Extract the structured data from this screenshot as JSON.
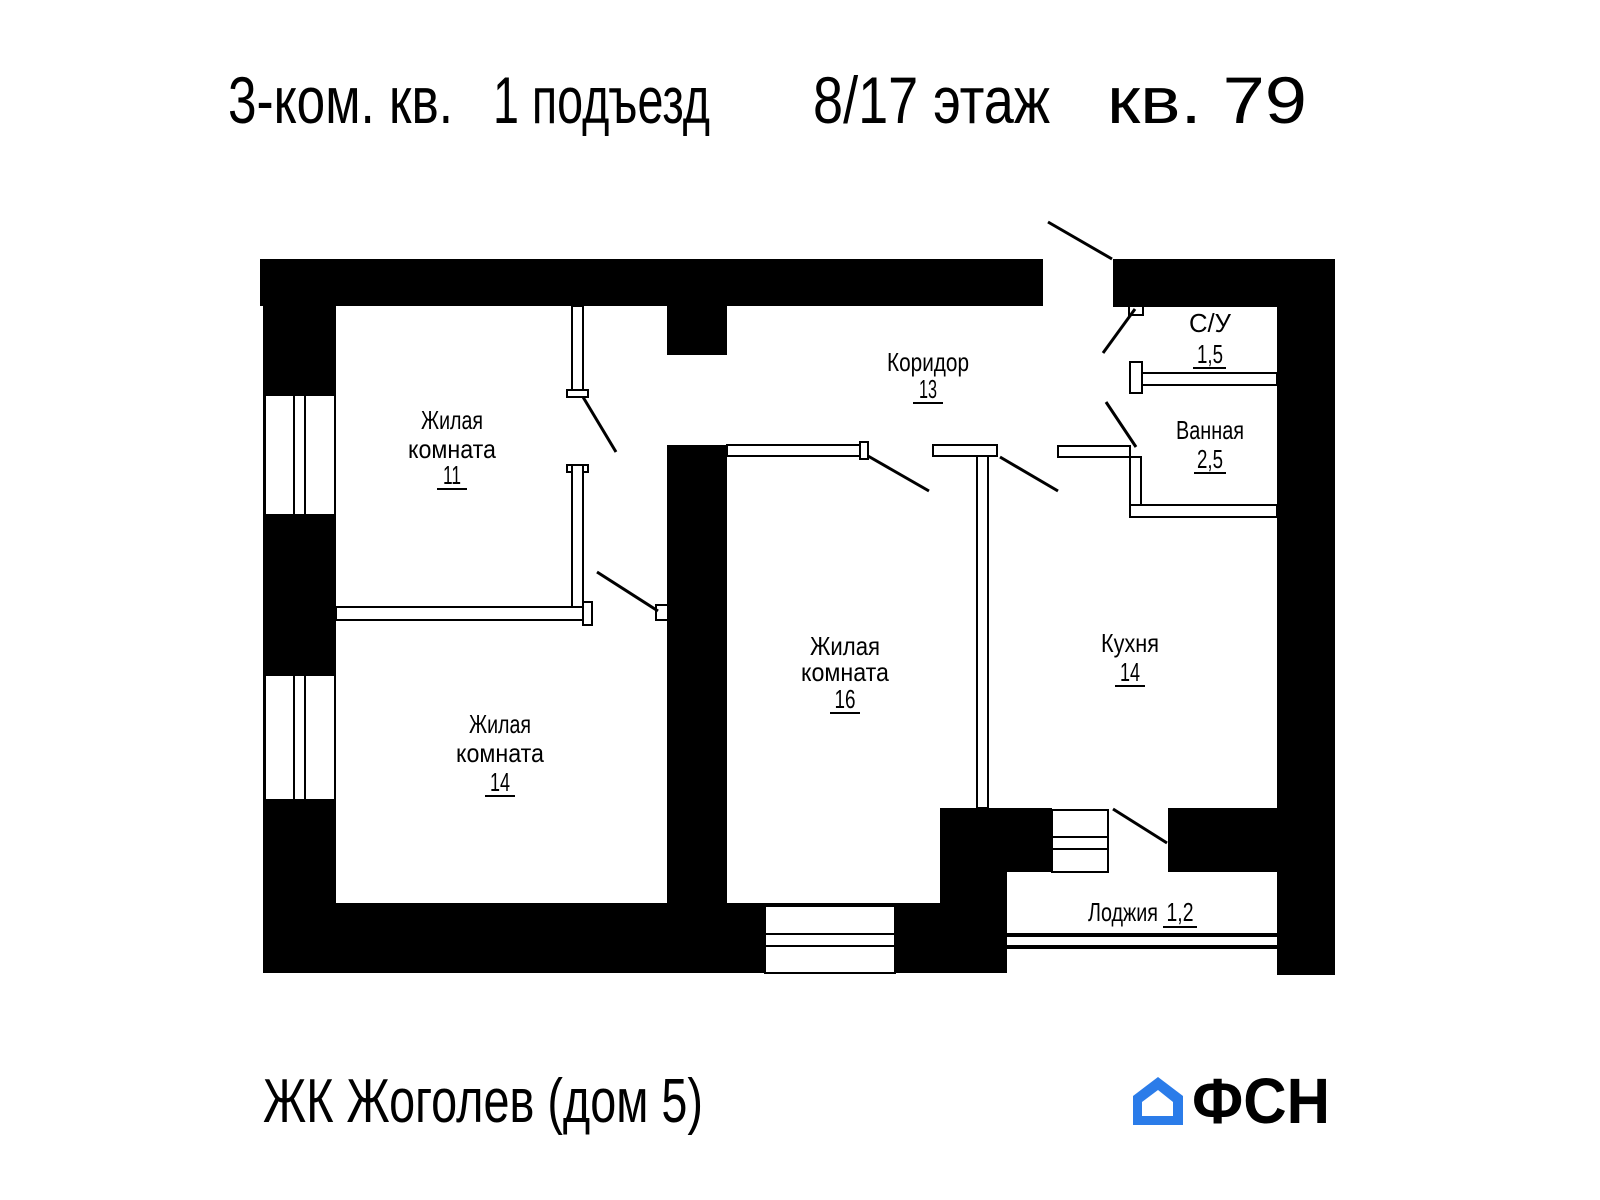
{
  "title": {
    "part1": "3-ком. кв.",
    "part2": "1 подъезд",
    "part3": "8/17 этаж",
    "part4": "кв. 79"
  },
  "rooms": {
    "living1": {
      "line1": "Жилая",
      "line2": "комната",
      "area": "11"
    },
    "living2": {
      "line1": "Жилая",
      "line2": "комната",
      "area": "14"
    },
    "living3": {
      "line1": "Жилая",
      "line2": "комната",
      "area": "16"
    },
    "corridor": {
      "name": "Коридор",
      "area": "13"
    },
    "wc": {
      "name": "С/У",
      "area": "1,5"
    },
    "bathroom": {
      "name": "Ванная",
      "area": "2,5"
    },
    "kitchen": {
      "name": "Кухня",
      "area": "14"
    },
    "loggia": {
      "name": "Лоджия",
      "area": "1,2"
    }
  },
  "footer": {
    "project": "ЖК Жоголев (дом 5)"
  },
  "logo": {
    "text": "ФСН"
  },
  "colors": {
    "wall": "#000000",
    "background": "#ffffff",
    "logo_blue": "#2b7ce9",
    "logo_dark": "#26282c"
  }
}
